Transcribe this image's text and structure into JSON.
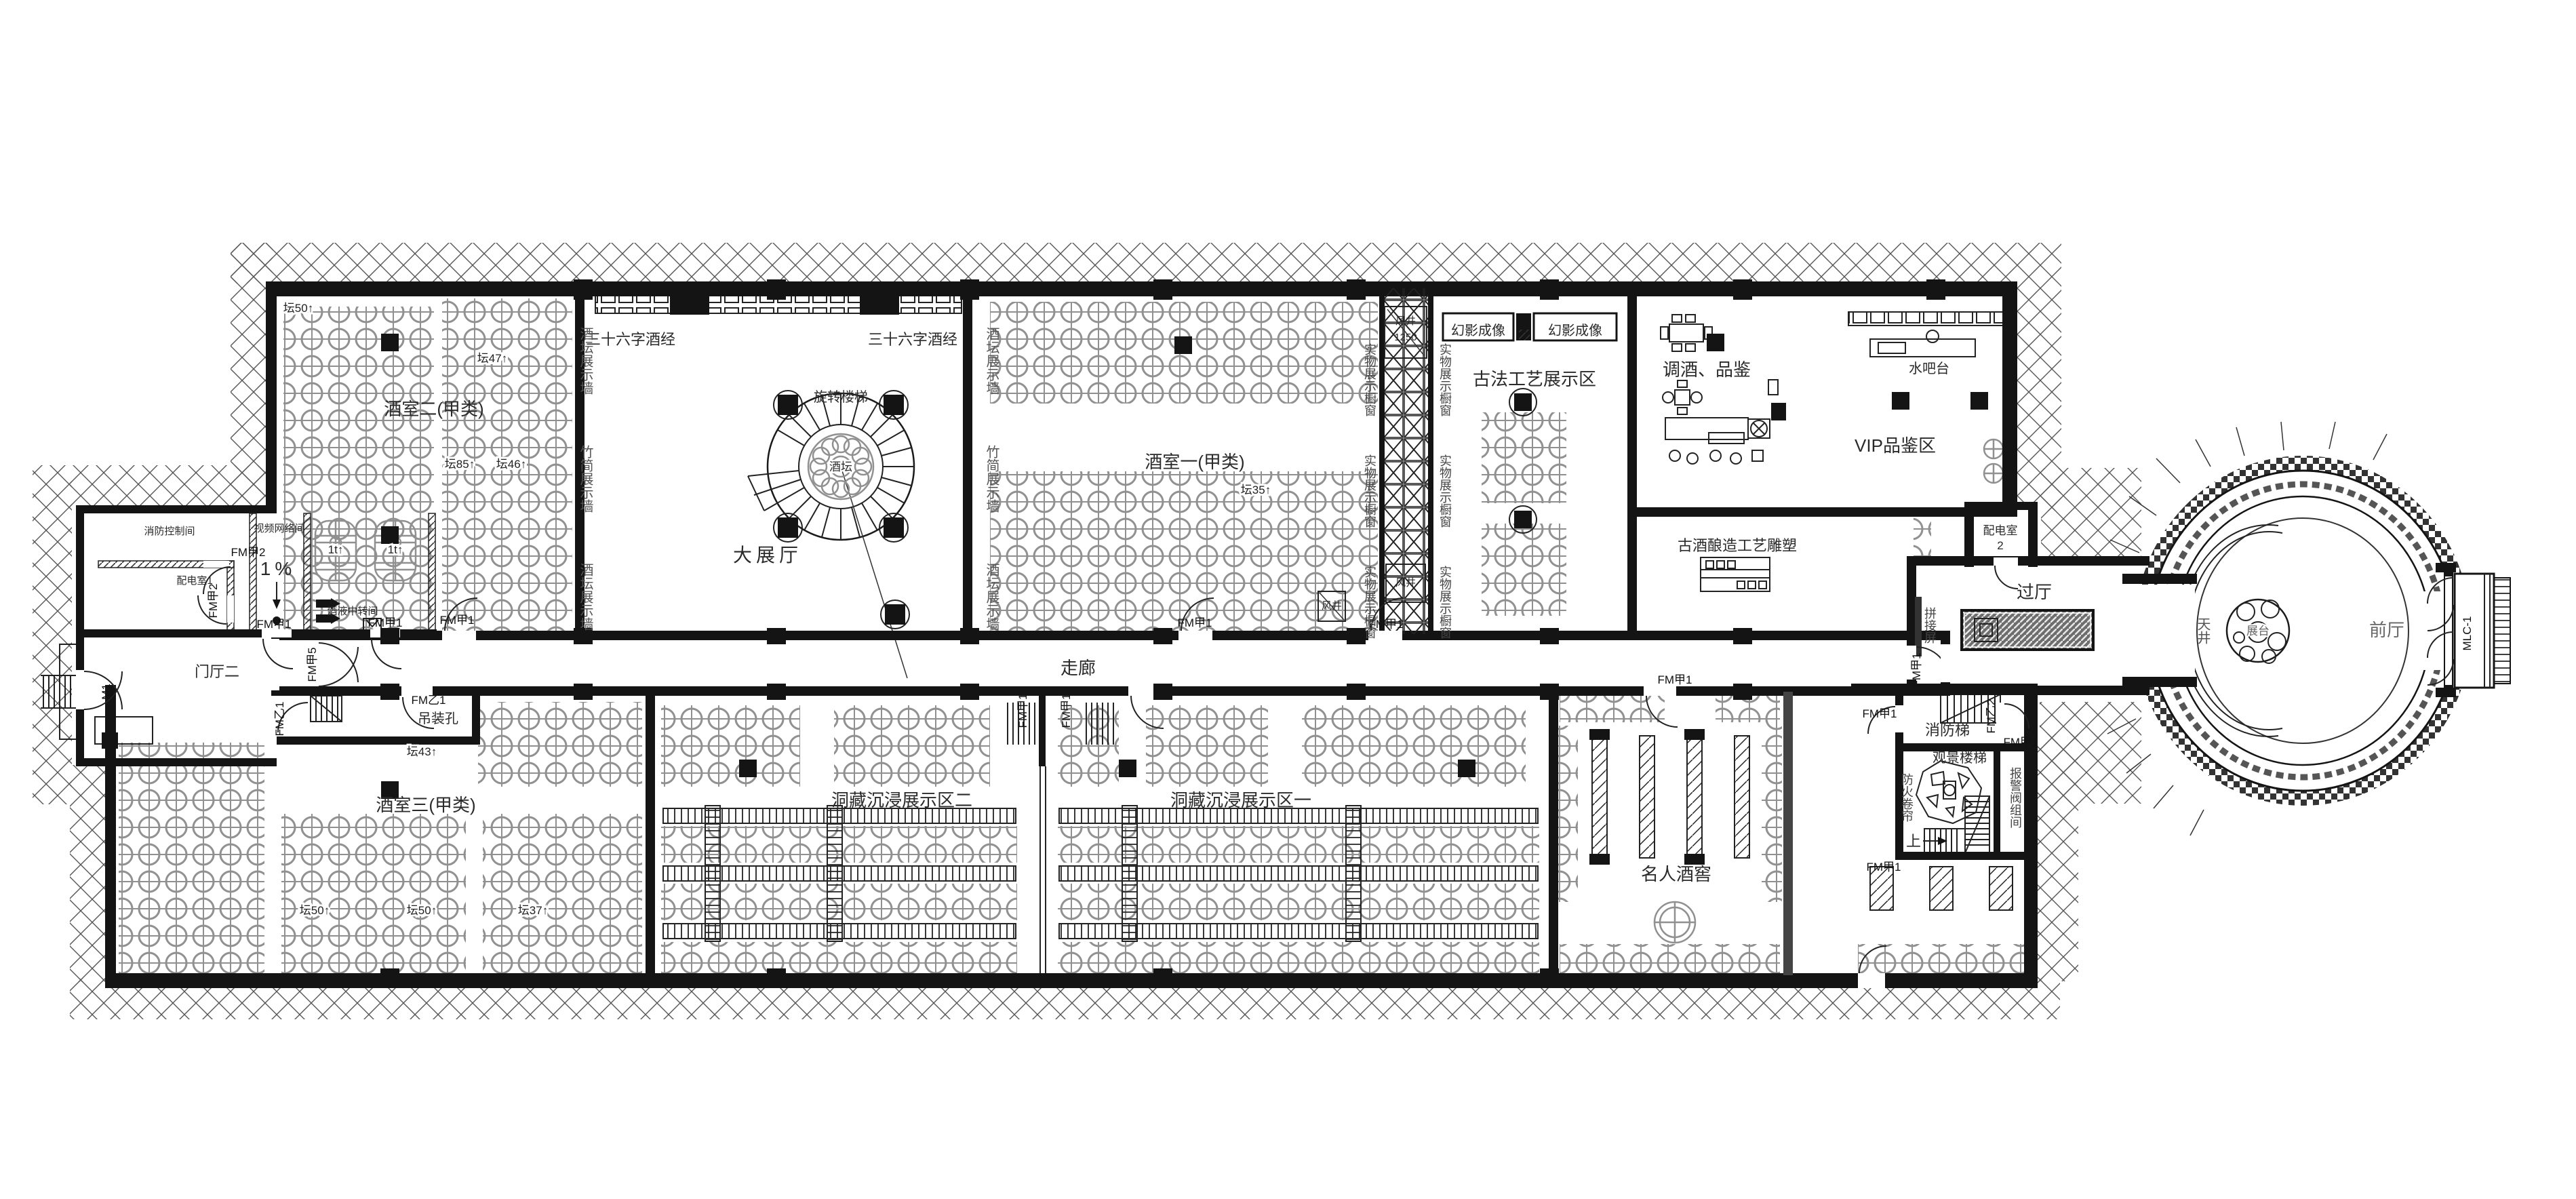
{
  "meta": {
    "drawing_type": "建筑平面图",
    "subject": "酒窖博物馆展览平面"
  },
  "palette": {
    "wall": "#141414",
    "jar": "#909090",
    "text": "#2a2a2a",
    "bg": "#ffffff"
  },
  "labels": {
    "grand_hall": "大展厅",
    "wine_room_1": "酒室一(甲类)",
    "wine_room_2": "酒室二(甲类)",
    "wine_room_3": "酒室三(甲类)",
    "scripture": "三十六字酒经",
    "palace_relief": "故宫浮雕",
    "spiral_stair": "旋转楼梯",
    "wine_jar": "酒坛",
    "phantom_imaging": "幻影成像",
    "ancient_craft_area": "古法工艺展示区",
    "mixology_tasting": "调酒、品鉴",
    "water_bar": "水吧台",
    "vip_tasting_area": "VIP品鉴区",
    "brewing_sculpture": "古酒酿造工艺雕塑",
    "distribution_room_2": "配电室",
    "distribution_room_2_no": "2",
    "transition_hall": "过厅",
    "corridor": "走廊",
    "immersive_area_2": "洞藏沉浸展示区二",
    "immersive_area_1": "洞藏沉浸展示区一",
    "celebrity_cellar": "名人酒窖",
    "fire_stair": "消防梯",
    "scenic_stair": "观景楼梯",
    "fire_shutter": "防火卷帘",
    "alarm_valve_room": "报警阀组间",
    "hoisting_hole": "吊装孔",
    "entrance_hall_2": "门厅二",
    "fire_control_room": "消防控制间",
    "video_network_room": "视频网络间",
    "distribution_room_1": "配电室1",
    "wine_transfer_room": "酒液中转间",
    "front_hall": "前厅",
    "atrium": "天井",
    "display_stand": "展台",
    "splice_screen": "拼接屏",
    "jar_display_wall": "酒坛展示墙",
    "bamboo_display_wall": "竹简展示墙",
    "showcase_window": "实物展示橱窗",
    "air_shaft": "风井",
    "air_shaft_no": "1250",
    "slope": "1%",
    "up": "上"
  },
  "counts": {
    "jars_50": "坛50↑",
    "jars_47": "坛47↑",
    "jars_85": "坛85↑",
    "jars_46": "坛46↑",
    "jars_35": "坛35↑",
    "jars_43": "坛43↑",
    "jars_37": "坛37↑",
    "tank": "1t↑"
  },
  "doors": {
    "m1": "M1",
    "fm_jia_1": "FM甲1",
    "fm_jia_2": "FM甲2",
    "fm_jia_5": "FM甲5",
    "fm_yi_1": "FM乙1",
    "fm_yi_2": "FM乙2",
    "mlc_1": "MLC-1"
  }
}
